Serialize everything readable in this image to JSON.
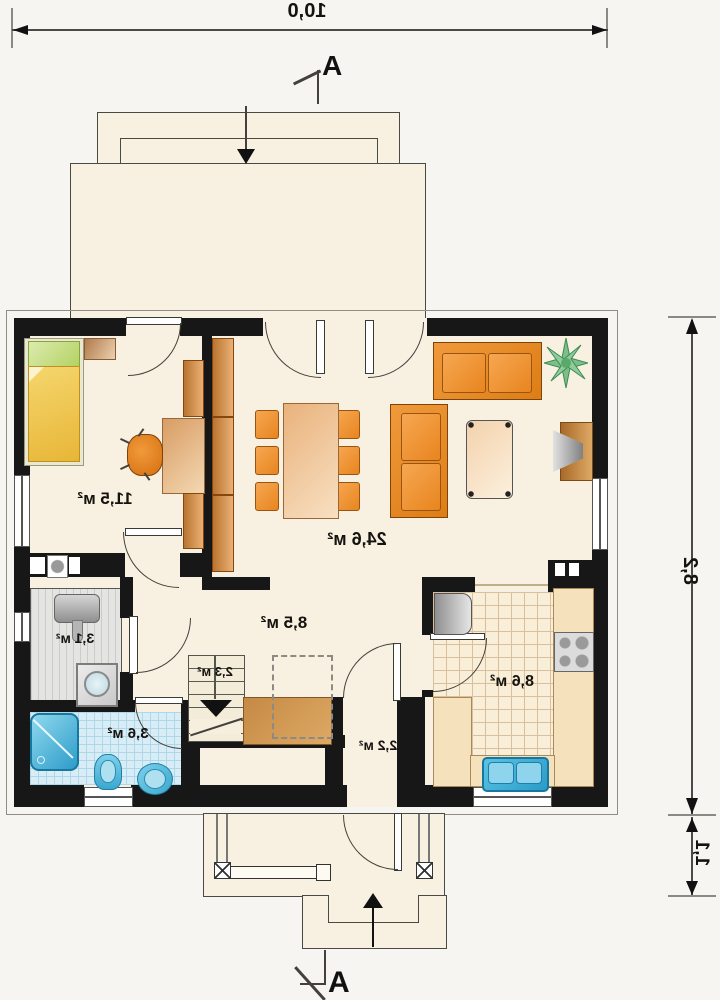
{
  "dimensions": {
    "top": "10,0",
    "right": "8,2",
    "porch": "1,1"
  },
  "section": {
    "top": "A",
    "bottom": "A"
  },
  "rooms": {
    "bedroom": {
      "area_label": "11,5 м²"
    },
    "living": {
      "area_label": "24,6 м²"
    },
    "hall": {
      "area_label": "8,5 м²"
    },
    "utility": {
      "area_label": "3,1 м²"
    },
    "stairs": {
      "area_label": "2,3 м²"
    },
    "bathroom": {
      "area_label": "3,6 м²"
    },
    "vestibule": {
      "area_label": "2,2 м²"
    },
    "kitchen": {
      "area_label": "8,6 м²"
    }
  },
  "colors": {
    "wall": "#171717",
    "floor_cream": "#f8f1e2",
    "furniture_orange": "#e8872b",
    "wood_brown": "#c58a45",
    "bed_yellow": "#efc548",
    "pillow_green": "#c3db7e",
    "tile_blue": "#d9edf7",
    "water_blue": "#4db8de",
    "utility_gray": "#e4e4e2",
    "kitchen_counter": "#f5e2bd",
    "plant_green": "#7cbf8a"
  }
}
